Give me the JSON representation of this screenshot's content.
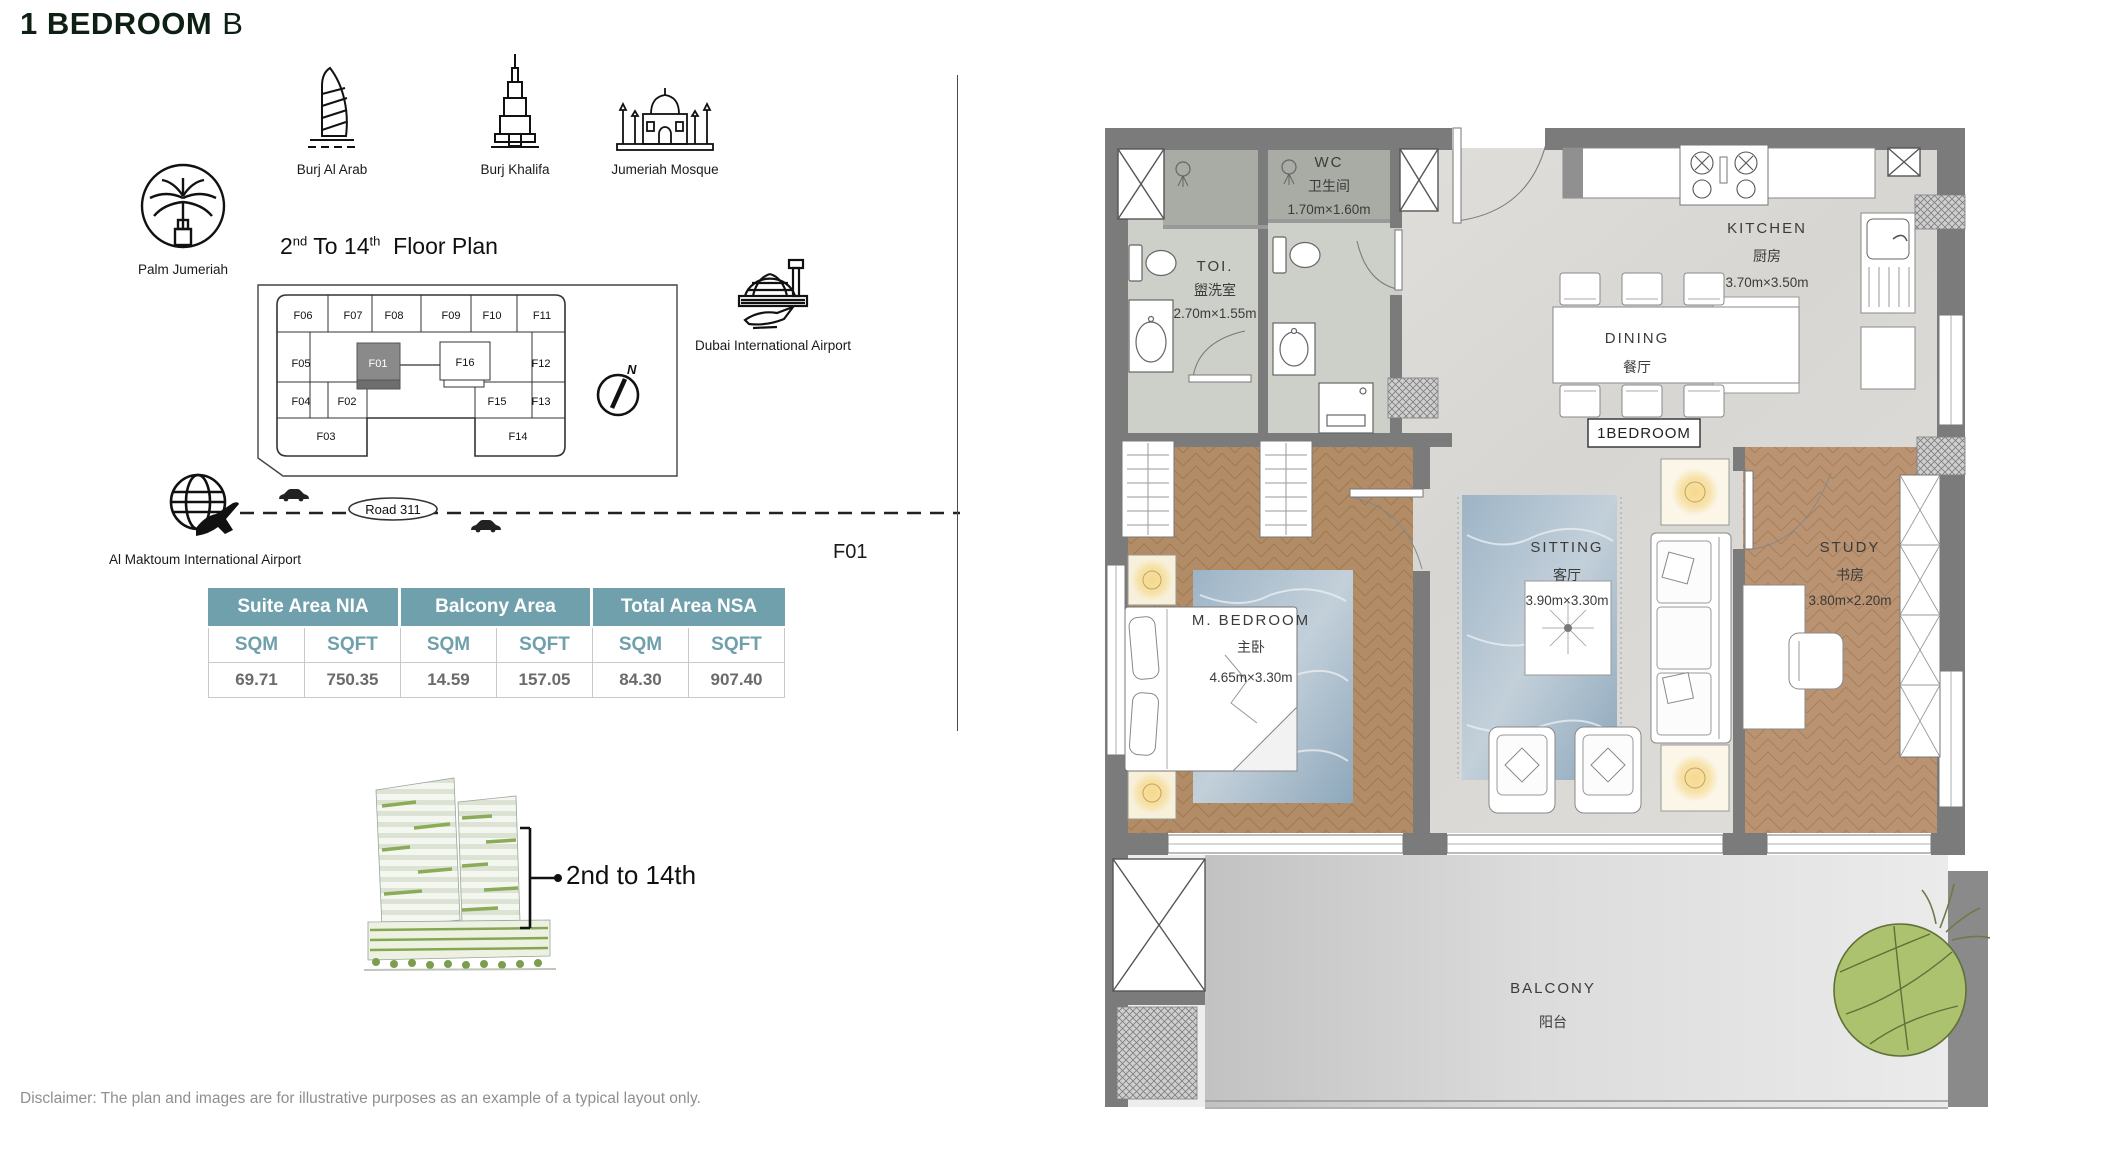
{
  "header": {
    "title_main": "1 BEDROOM",
    "title_suffix": "B"
  },
  "landmarks": {
    "burj_al_arab": "Burj Al Arab",
    "burj_khalifa": "Burj Khalifa",
    "jumeriah_mosque": "Jumeriah Mosque",
    "palm_jumeriah": "Palm Jumeriah",
    "dubai_airport": "Dubai International Airport",
    "al_maktoum_airport": "Al Maktoum International Airport"
  },
  "key_plan": {
    "heading": {
      "num1": "2",
      "sup1": "nd",
      "mid": "To 14",
      "sup2": "th",
      "rest": "Floor Plan"
    },
    "units": {
      "f01": "F01",
      "f02": "F02",
      "f03": "F03",
      "f04": "F04",
      "f05": "F05",
      "f06": "F06",
      "f07": "F07",
      "f08": "F08",
      "f09": "F09",
      "f10": "F10",
      "f11": "F11",
      "f12": "F12",
      "f13": "F13",
      "f14": "F14",
      "f15": "F15",
      "f16": "F16"
    },
    "north_label": "N",
    "road_label": "Road 311",
    "selected_unit_callout": "F01"
  },
  "area_table": {
    "group_headers": [
      "Suite Area NIA",
      "Balcony Area",
      "Total Area NSA"
    ],
    "unit_headers": [
      "SQM",
      "SQFT",
      "SQM",
      "SQFT",
      "SQM",
      "SQFT"
    ],
    "values": [
      "69.71",
      "750.35",
      "14.59",
      "157.05",
      "84.30",
      "907.40"
    ]
  },
  "building": {
    "floor_range": "2nd to 14th"
  },
  "floor_plan": {
    "unit_tag": "1BEDROOM",
    "rooms": {
      "wc": {
        "name": "WC",
        "name_cn": "卫生间",
        "dims": "1.70m×1.60m"
      },
      "toi": {
        "name": "TOI.",
        "name_cn": "盥洗室",
        "dims": "2.70m×1.55m"
      },
      "kitchen": {
        "name": "KITCHEN",
        "name_cn": "厨房",
        "dims": "3.70m×3.50m"
      },
      "dining": {
        "name": "DINING",
        "name_cn": "餐厅"
      },
      "m_bedroom": {
        "name": "M. BEDROOM",
        "name_cn": "主卧",
        "dims": "4.65m×3.30m"
      },
      "sitting": {
        "name": "SITTING",
        "name_cn": "客厅",
        "dims": "3.90m×3.30m"
      },
      "study": {
        "name": "STUDY",
        "name_cn": "书房",
        "dims": "3.80m×2.20m"
      },
      "balcony": {
        "name": "BALCONY",
        "name_cn": "阳台"
      }
    }
  },
  "footer": {
    "disclaimer": "Disclaimer: The plan and images are for illustrative purposes as an example of a typical layout only."
  },
  "colors": {
    "table_header_bg": "#6FA0AC",
    "wall": "#7B7B7B",
    "wood": "#B28C66",
    "rug": "#9DB4C6",
    "plant": "#ADC26F"
  }
}
